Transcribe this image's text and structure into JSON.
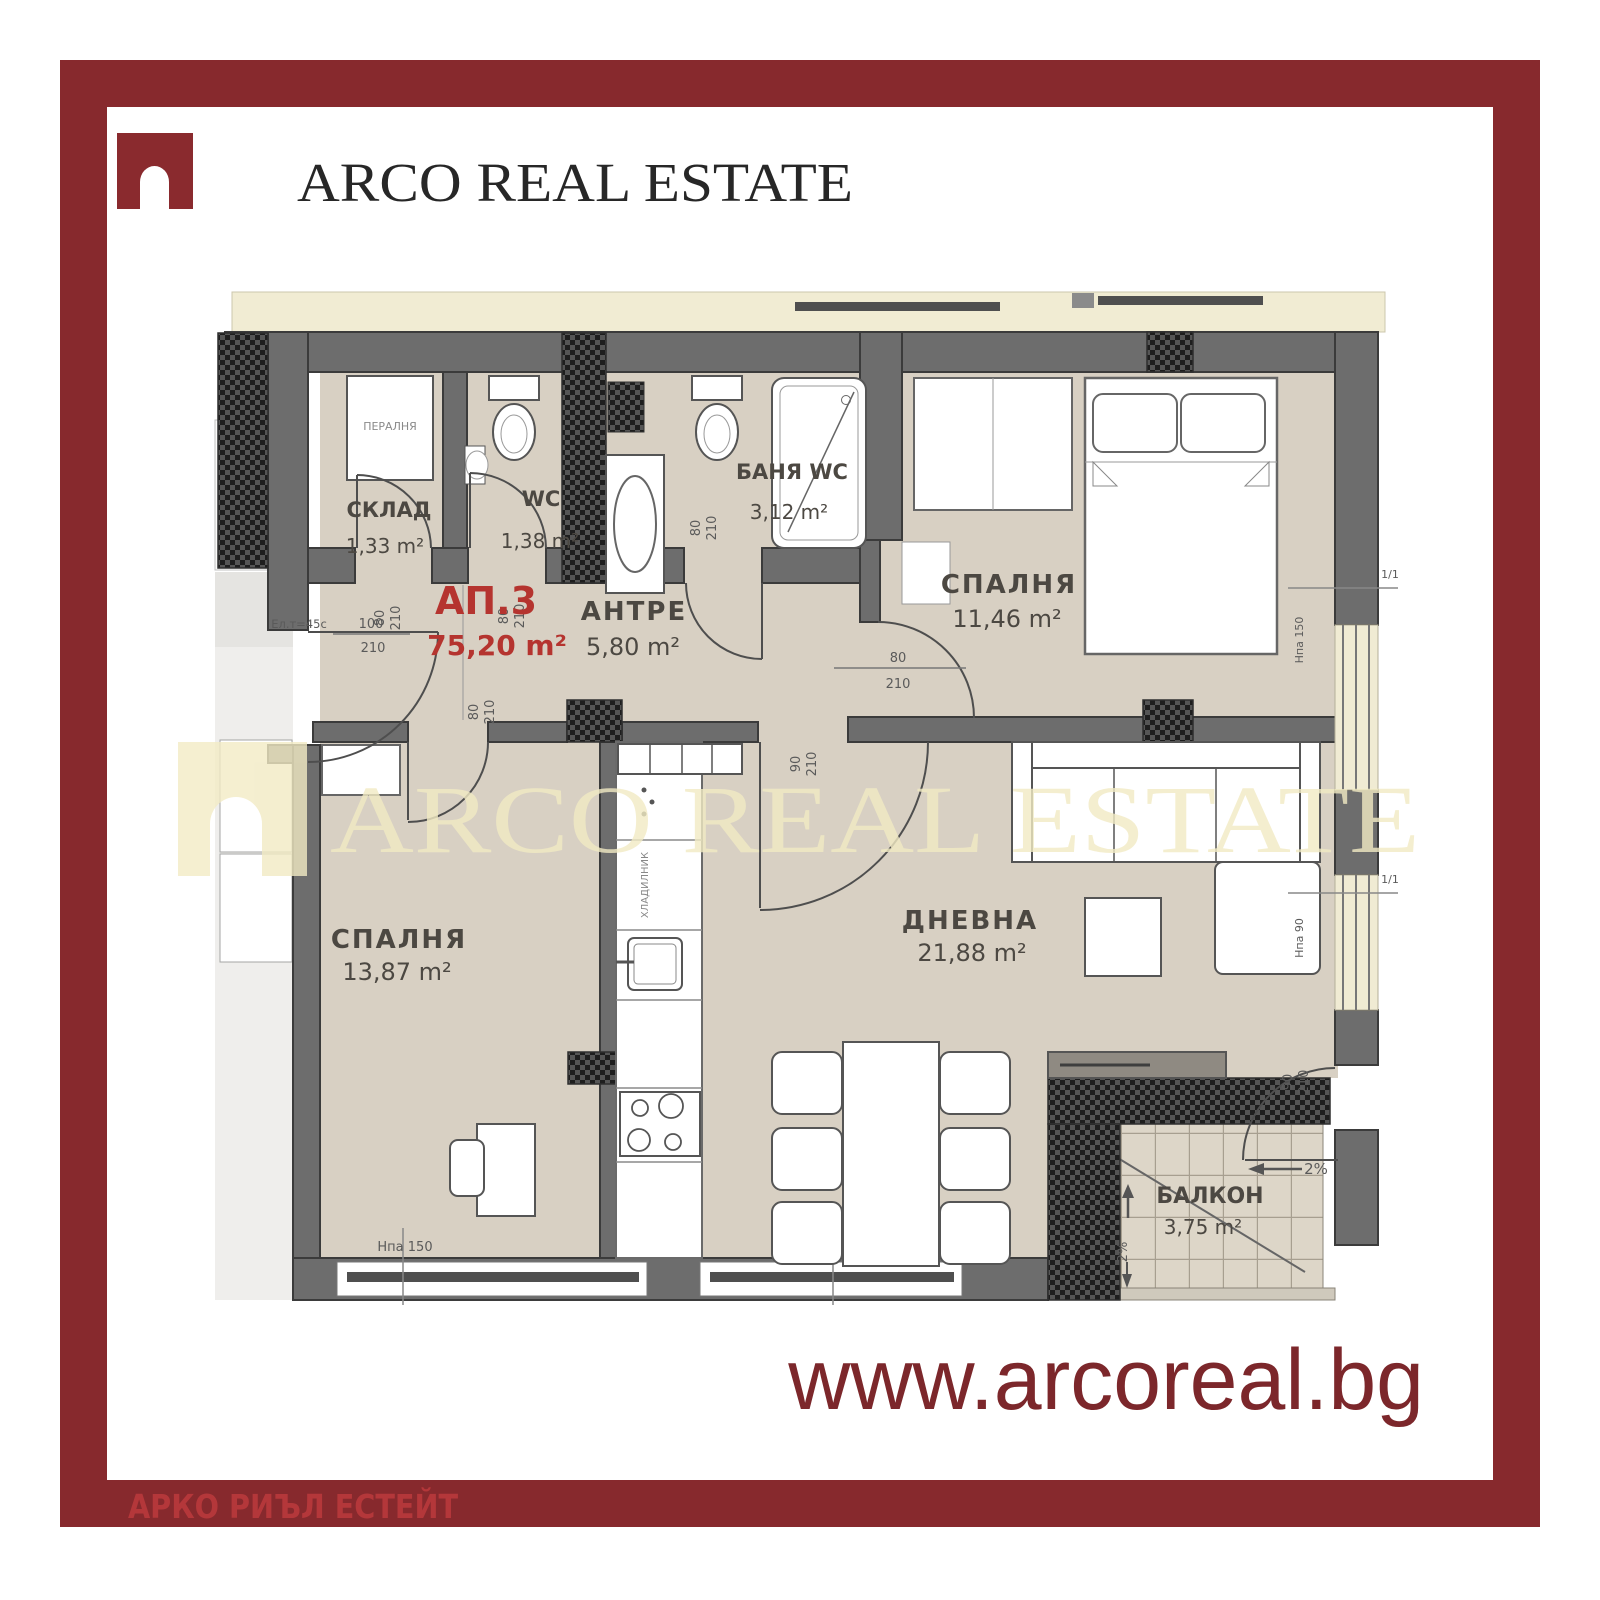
{
  "header": {
    "brand": "ARCO REAL ESTATE"
  },
  "footer": {
    "left_text": "АРКО РИЪЛ ЕСТЕЙТ",
    "website": "www.arcoreal.bg"
  },
  "watermark": {
    "text": "ARCO REAL ESTATE"
  },
  "colors": {
    "frame": "#87292d",
    "logo": "#8a2a2e",
    "footer_text": "#b8393c",
    "website_text": "#7c272b",
    "apartment_label": "#b5342f",
    "wall": "#6d6d6d",
    "floor": "#d8d0c3",
    "terrace_strip": "#f1ecd3",
    "watermark": "#f2ebc4"
  },
  "plan": {
    "apartment_label": "АП.3",
    "apartment_area": "75,20 m²",
    "rooms": {
      "storage": {
        "name": "СКЛАД",
        "area": "1,33 m²"
      },
      "wc": {
        "name": "WC",
        "area": "1,38 m²"
      },
      "bathroom": {
        "name": "БАНЯ WC",
        "area": "3,12 m²"
      },
      "hallway": {
        "name": "АНТРЕ",
        "area": "5,80 m²"
      },
      "bedroom1": {
        "name": "СПАЛНЯ",
        "area": "11,46 m²"
      },
      "bedroom2": {
        "name": "СПАЛНЯ",
        "area": "13,87 m²"
      },
      "living": {
        "name": "ДНЕВНА",
        "area": "21,88 m²"
      },
      "balcony": {
        "name": "БАЛКОН",
        "area": "3,75 m²"
      }
    },
    "appliances": {
      "washing_machine": "ПЕРАЛНЯ",
      "fridge": "ХЛАДИЛНИК"
    },
    "dims": {
      "entrance": {
        "w": "100",
        "h": "210"
      },
      "storage_door": {
        "w": "80",
        "h": "210"
      },
      "wc_door": {
        "w": "80",
        "h": "210"
      },
      "bath_door": {
        "w": "80",
        "h": "210"
      },
      "bedroom1_door": {
        "w": "80",
        "h": "210"
      },
      "bedroom2_door": {
        "w": "80",
        "h": "210"
      },
      "living_door": {
        "w": "90",
        "h": "210"
      },
      "balcony_door": {
        "w": "90",
        "h": "210"
      }
    },
    "annotations": {
      "electrical": "Ел.т=45с",
      "window_bottom": "Hпа 150",
      "window_right1": "Hпа 150",
      "window_right2": "Hпа 90",
      "slope1": "2%",
      "slope2": "2%",
      "win_mark1": "1/1",
      "win_mark2": "1/1"
    }
  }
}
